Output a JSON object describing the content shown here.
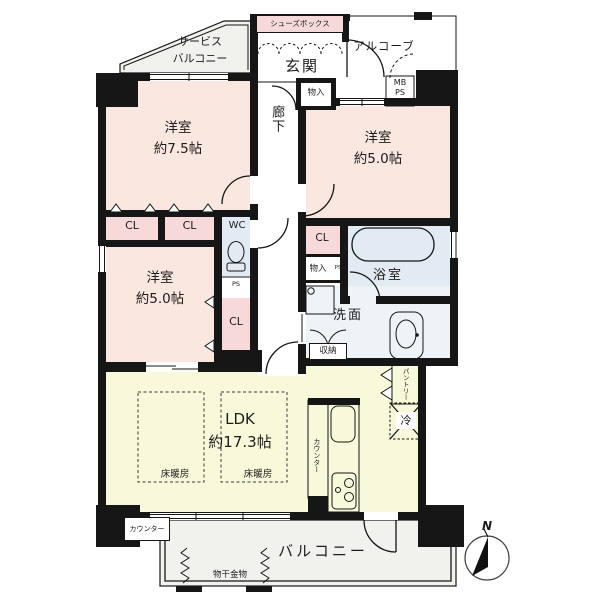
{
  "colors": {
    "wall": "#161616",
    "room": "#fae7df",
    "closet": "#f8d9da",
    "water": "#e2ebf3",
    "water_light": "#eef3f8",
    "ldk": "#f8f8db",
    "outdoor": "#f1f1ee",
    "paper": "#ffffff"
  },
  "plan": {
    "outdoor": {
      "service_balcony": "サービス\nバルコニー",
      "alcove": "アルコーブ",
      "balcony": "バルコニー",
      "laundry_fitting": "物干金物"
    },
    "entrance": {
      "shoe_box": "シューズボックス",
      "genkan": "玄関",
      "storage": "物入",
      "mb_ps": "MB\nPS"
    },
    "rooms": {
      "bedroom_75": "洋室\n約7.5帖",
      "bedroom_50": "洋室\n約5.0帖",
      "ldk": "LDK\n約17.3帖",
      "corridor": "廊下",
      "bath": "浴室",
      "washroom": "洗面",
      "wc": "WC"
    },
    "storage": {
      "closet": "CL",
      "oshiire": "収納",
      "pantry": "パントリー",
      "storage_small": "物入",
      "ps": "PS"
    },
    "fixtures": {
      "fridge": "冷",
      "floor_heating": "床暖房",
      "counter": "カウンター"
    },
    "compass": {
      "north": "N"
    }
  }
}
